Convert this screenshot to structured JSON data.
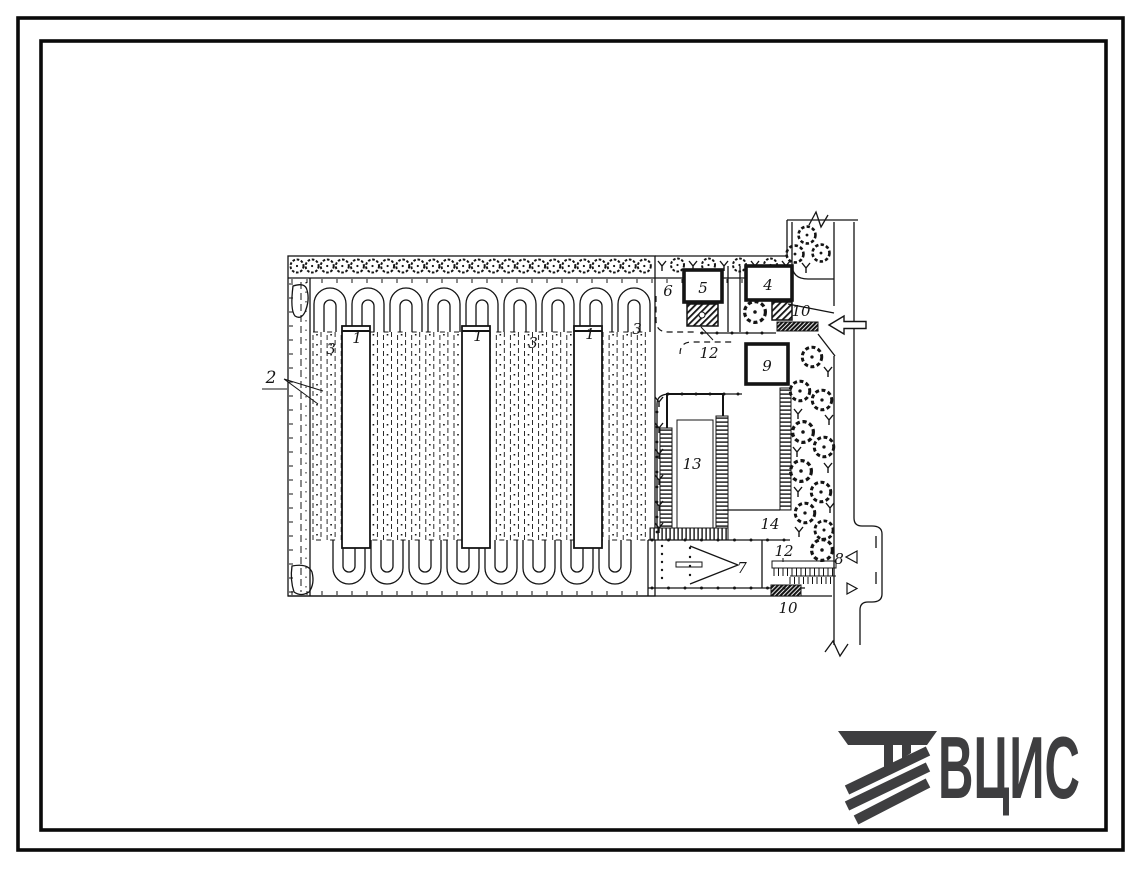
{
  "logo": {
    "text": "ВЦИС"
  },
  "colors": {
    "ink": "#141414",
    "logo_gray": "#3e3e40",
    "paper": "#ffffff"
  },
  "plan": {
    "labels": [
      {
        "text": "2"
      },
      {
        "text": "3"
      },
      {
        "text": "1"
      },
      {
        "text": "1"
      },
      {
        "text": "3"
      },
      {
        "text": "1"
      },
      {
        "text": "3"
      },
      {
        "text": "6"
      },
      {
        "text": "5"
      },
      {
        "text": "4"
      },
      {
        "text": "10"
      },
      {
        "text": "12"
      },
      {
        "text": "9"
      },
      {
        "text": "13"
      },
      {
        "text": "14"
      },
      {
        "text": "7"
      },
      {
        "text": "12"
      },
      {
        "text": "8"
      },
      {
        "text": "10"
      }
    ]
  }
}
